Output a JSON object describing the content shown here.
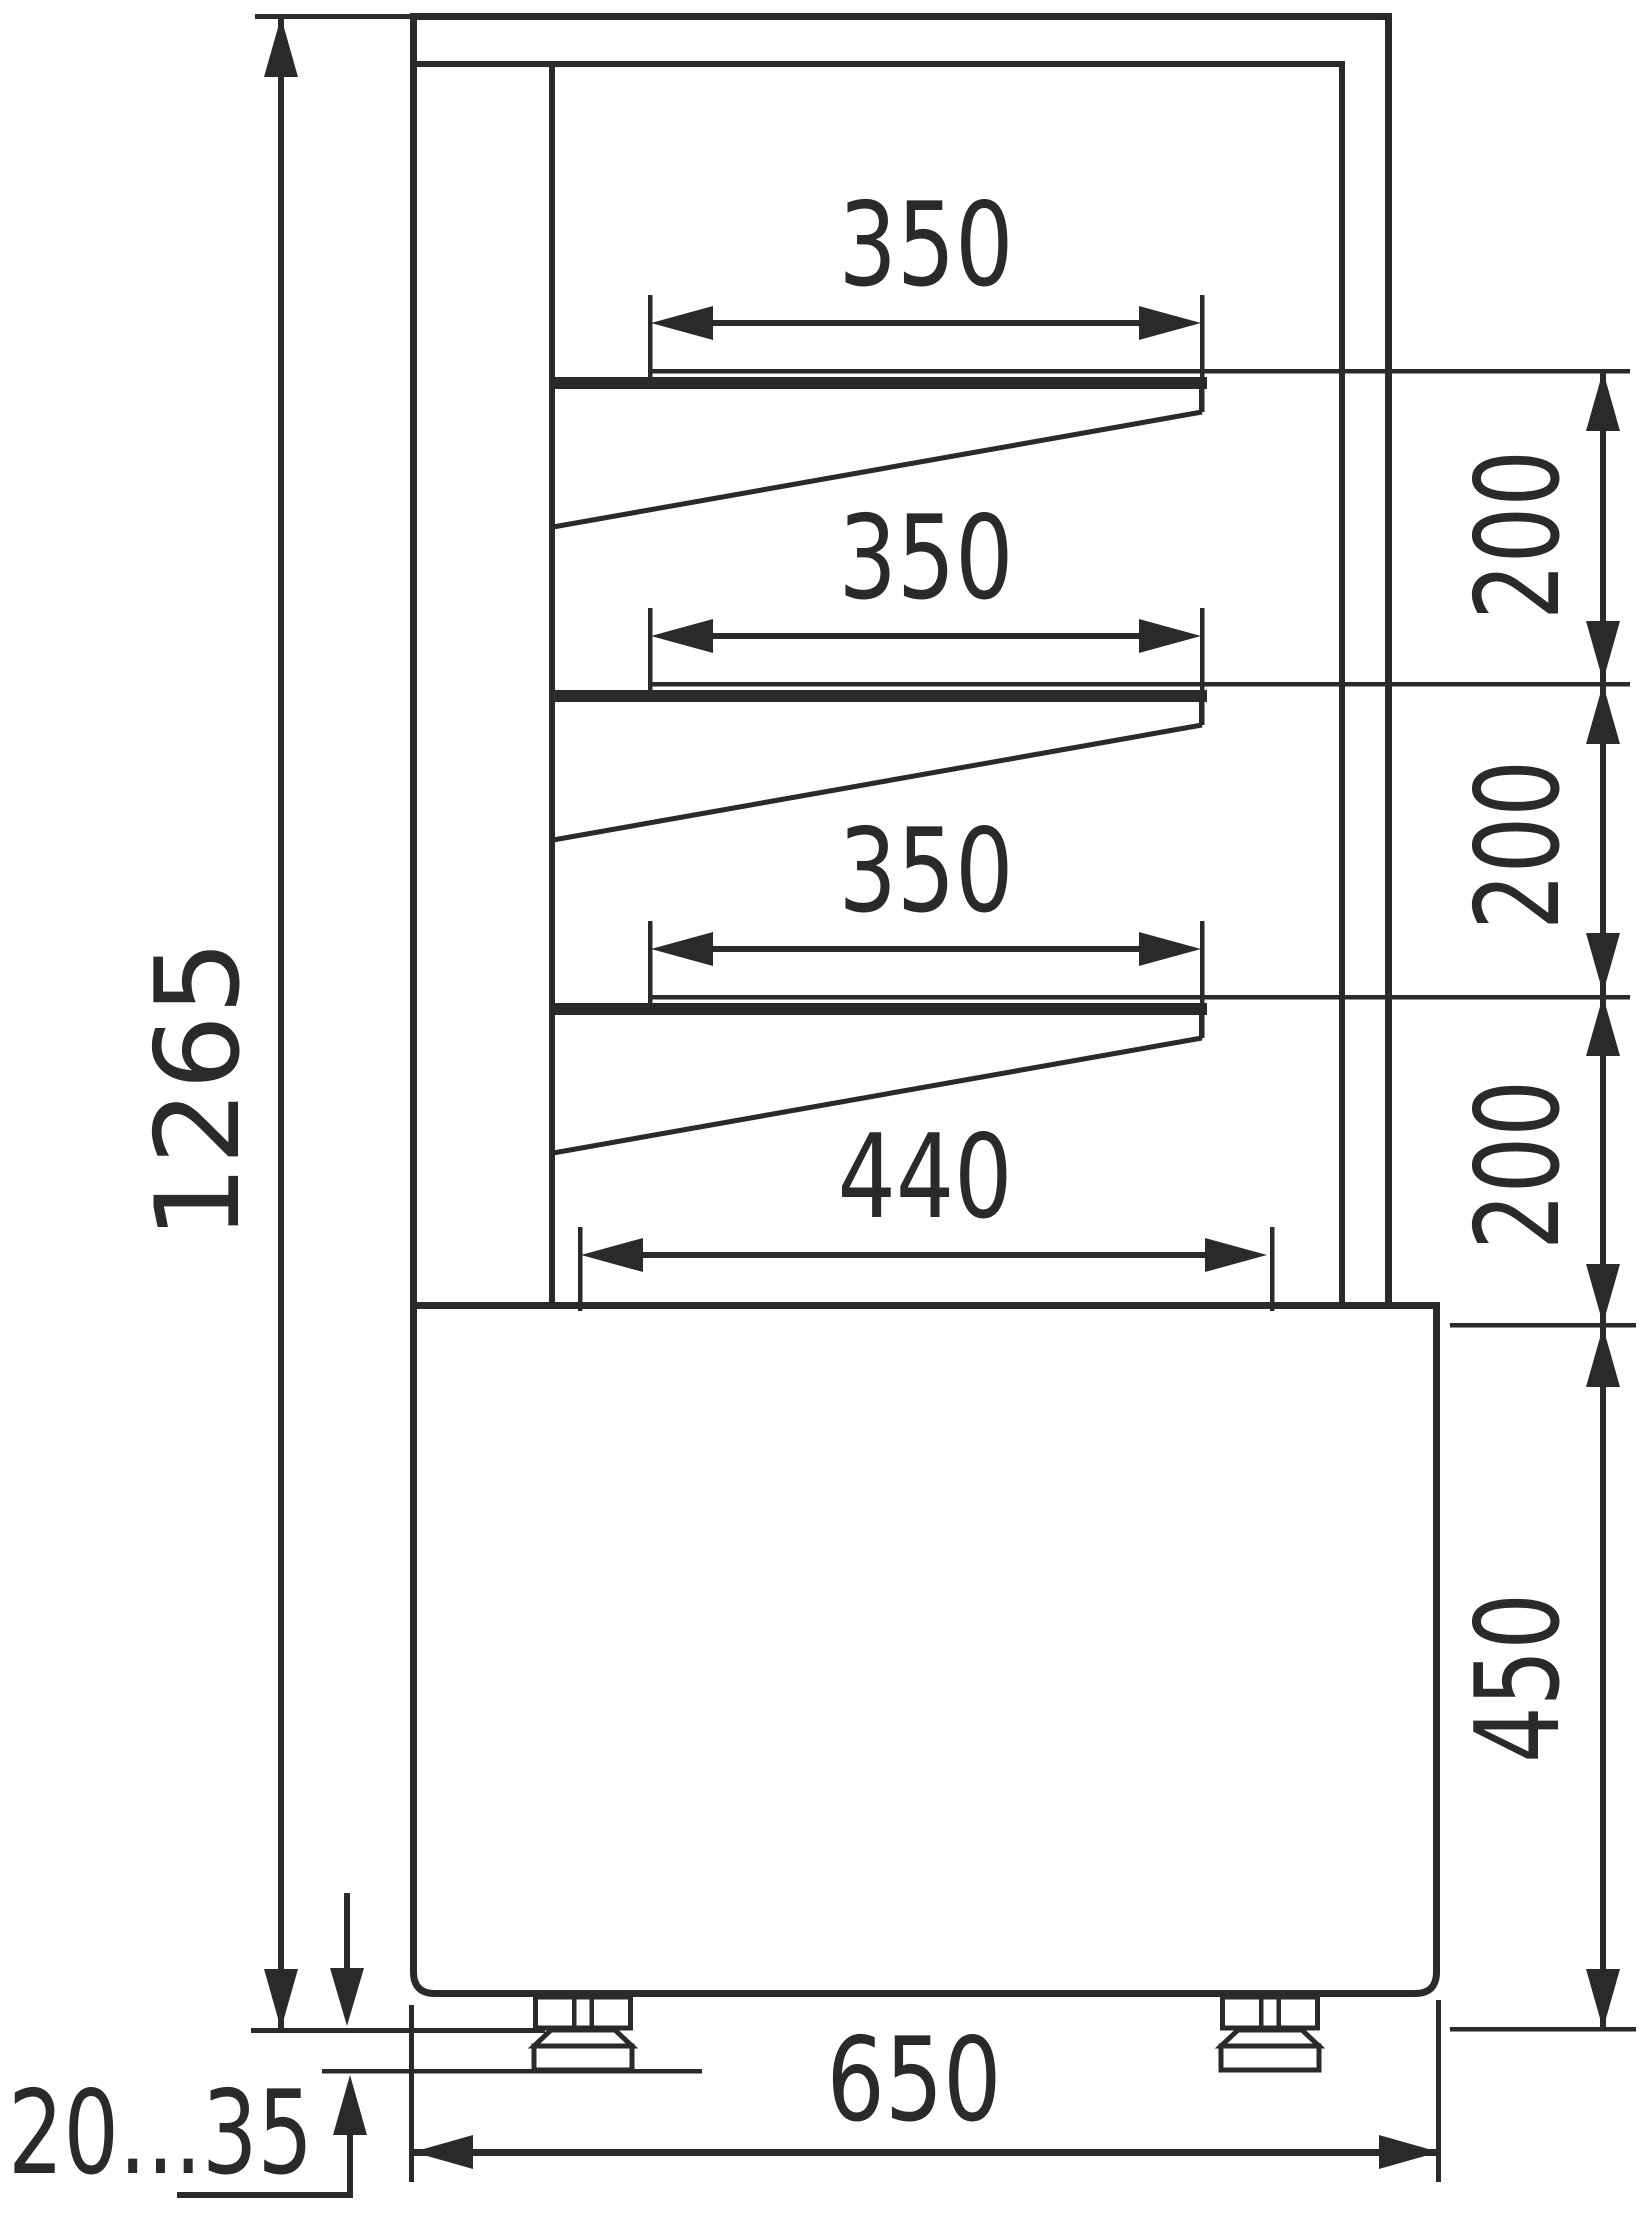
{
  "colors": {
    "ink": "#2b2a29",
    "background": "#ffffff"
  },
  "dims": {
    "overall_height": "1265",
    "shelf1": "350",
    "shelf2": "350",
    "shelf3": "350",
    "gap1": "200",
    "gap2": "200",
    "gap3": "200",
    "deck": "440",
    "base_height": "450",
    "depth": "650",
    "feet_range": "20...35"
  }
}
